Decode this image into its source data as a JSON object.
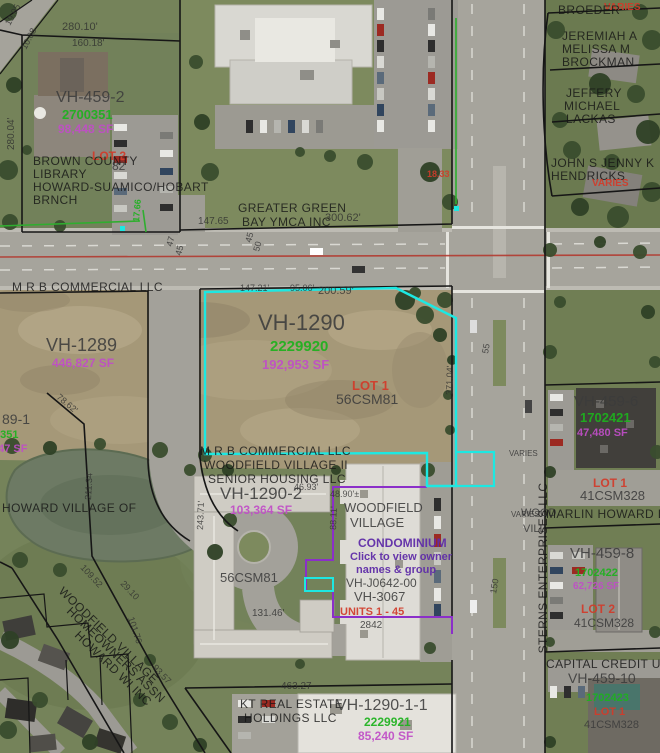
{
  "map": {
    "selected_parcel": "VH-1290",
    "colors": {
      "highlight": "#1de8e2",
      "boundary": "#161616",
      "condo_boundary": "#8b2fc9",
      "road_centerline": "#b23a30",
      "survey_green": "#2fae2f",
      "value_green": "#1db21d",
      "area_magenta": "#c04ec7",
      "lot_red": "#d23b2a"
    },
    "labels": [
      {
        "name": "dim-280-10",
        "text": "280.10'",
        "x": 62,
        "y": 30,
        "cls": "dim",
        "size": 11
      },
      {
        "name": "dim-160-18",
        "text": "160.18'",
        "x": 72,
        "y": 46,
        "cls": "dim",
        "size": 10
      },
      {
        "name": "dim-19-95",
        "text": "19.95",
        "x": 10,
        "y": 26,
        "cls": "dim",
        "size": 9,
        "rot": -62
      },
      {
        "name": "dim-10-08",
        "text": "10.08",
        "x": 26,
        "y": 50,
        "cls": "dim",
        "size": 9,
        "rot": -62
      },
      {
        "name": "dim-280-04",
        "text": "280.04'",
        "x": 14,
        "y": 150,
        "cls": "dim",
        "size": 10,
        "rot": -90
      },
      {
        "name": "parcel-id-vh-459-2",
        "text": "VH-459-2",
        "x": 56,
        "y": 102,
        "cls": "id",
        "size": 16
      },
      {
        "name": "parcel-value-vh-459-2",
        "text": "2700351",
        "x": 62,
        "y": 119,
        "cls": "grn",
        "size": 13
      },
      {
        "name": "parcel-area-vh-459-2",
        "text": "98,448 SF",
        "x": 58,
        "y": 133,
        "cls": "mag",
        "size": 12
      },
      {
        "name": "lot-label-vh-459-2",
        "text": "LOT 2",
        "x": 92,
        "y": 160,
        "cls": "red",
        "size": 12
      },
      {
        "name": "csm-fragment-82",
        "text": "82",
        "x": 112,
        "y": 170,
        "cls": "id",
        "size": 12
      },
      {
        "name": "owner-library-1",
        "text": "BROWN COUNTY",
        "x": 33,
        "y": 165,
        "cls": "own"
      },
      {
        "name": "owner-library-2",
        "text": "LIBRARY",
        "x": 33,
        "y": 178,
        "cls": "own"
      },
      {
        "name": "owner-library-3",
        "text": "HOWARD-SUAMICO/HOBART",
        "x": 33,
        "y": 191,
        "cls": "own"
      },
      {
        "name": "owner-library-4",
        "text": "BRNCH",
        "x": 33,
        "y": 204,
        "cls": "own"
      },
      {
        "name": "owner-ymca-1",
        "text": "GREATER GREEN",
        "x": 238,
        "y": 212,
        "cls": "own"
      },
      {
        "name": "owner-ymca-2",
        "text": "BAY YMCA INC",
        "x": 242,
        "y": 226,
        "cls": "own"
      },
      {
        "name": "dim-147-65",
        "text": "147.65",
        "x": 198,
        "y": 224,
        "cls": "dim",
        "size": 10
      },
      {
        "name": "dim-300-62",
        "text": "300.62'",
        "x": 325,
        "y": 221,
        "cls": "dim",
        "size": 11
      },
      {
        "name": "dim-47",
        "text": "47",
        "x": 172,
        "y": 247,
        "cls": "dim",
        "size": 9,
        "rot": -75
      },
      {
        "name": "dim-45a",
        "text": "45",
        "x": 181,
        "y": 256,
        "cls": "dim",
        "size": 9,
        "rot": -75
      },
      {
        "name": "dim-45b",
        "text": "45",
        "x": 251,
        "y": 243,
        "cls": "dim",
        "size": 9,
        "rot": -75
      },
      {
        "name": "dim-50",
        "text": "50",
        "x": 259,
        "y": 252,
        "cls": "dim",
        "size": 9,
        "rot": -75
      },
      {
        "name": "dim-18-33",
        "text": "18.33",
        "x": 427,
        "y": 177,
        "cls": "red",
        "size": 9
      },
      {
        "name": "dim-17-66",
        "text": "17.66",
        "x": 139,
        "y": 222,
        "cls": "grn",
        "size": 9,
        "rot": -85
      },
      {
        "name": "dim-147-21",
        "text": "147.21'",
        "x": 240,
        "y": 291,
        "cls": "dim",
        "size": 9
      },
      {
        "name": "dim-95-06",
        "text": "95.06'",
        "x": 290,
        "y": 291,
        "cls": "dim",
        "size": 9
      },
      {
        "name": "dim-200-59",
        "text": "200.59'",
        "x": 318,
        "y": 294,
        "cls": "dim",
        "size": 11
      },
      {
        "name": "dim-varies-1",
        "text": "VARIES",
        "x": 604,
        "y": 10,
        "cls": "red",
        "size": 10
      },
      {
        "name": "owner-broeder",
        "text": "BROEDER",
        "x": 558,
        "y": 14,
        "cls": "own",
        "size": 10
      },
      {
        "name": "owner-brockman-1",
        "text": "JEREMIAH A",
        "x": 562,
        "y": 40,
        "cls": "own"
      },
      {
        "name": "owner-brockman-2",
        "text": "MELISSA M",
        "x": 562,
        "y": 53,
        "cls": "own"
      },
      {
        "name": "owner-brockman-3",
        "text": "BROCKMAN",
        "x": 562,
        "y": 66,
        "cls": "own"
      },
      {
        "name": "owner-lackas-1",
        "text": "JEFFERY",
        "x": 566,
        "y": 97,
        "cls": "own"
      },
      {
        "name": "owner-lackas-2",
        "text": "MICHAEL",
        "x": 564,
        "y": 110,
        "cls": "own"
      },
      {
        "name": "owner-lackas-3",
        "text": "LACKAS",
        "x": 566,
        "y": 123,
        "cls": "own"
      },
      {
        "name": "owner-hendricks-1",
        "text": "JOHN S JENNY K",
        "x": 551,
        "y": 167,
        "cls": "own"
      },
      {
        "name": "owner-hendricks-2",
        "text": "HENDRICKS",
        "x": 551,
        "y": 180,
        "cls": "own"
      },
      {
        "name": "dim-varies-2",
        "text": "VARIES",
        "x": 592,
        "y": 186,
        "cls": "red",
        "size": 10
      },
      {
        "name": "owner-mrb-north",
        "text": "M R B COMMERCIAL LLC",
        "x": 12,
        "y": 291,
        "cls": "own"
      },
      {
        "name": "parcel-id-vh-1289",
        "text": "VH-1289",
        "x": 46,
        "y": 351,
        "cls": "id",
        "size": 18
      },
      {
        "name": "parcel-area-vh-1289",
        "text": "446,827 SF",
        "x": 52,
        "y": 367,
        "cls": "mag",
        "size": 12
      },
      {
        "name": "parcel-id-vh-1289-1",
        "text": "89-1",
        "x": 2,
        "y": 424,
        "cls": "id",
        "size": 14
      },
      {
        "name": "parcel-value-vh-1289-1",
        "text": "0351",
        "x": -6,
        "y": 438,
        "cls": "grn",
        "size": 11
      },
      {
        "name": "parcel-area-vh-1289-1",
        "text": "947 SF",
        "x": -8,
        "y": 452,
        "cls": "mag",
        "size": 11
      },
      {
        "name": "owner-howard-village",
        "text": "HOWARD VILLAGE OF",
        "x": 2,
        "y": 512,
        "cls": "own",
        "size": 11
      },
      {
        "name": "dim-78-62",
        "text": "78.62'",
        "x": 56,
        "y": 398,
        "cls": "dim",
        "size": 9,
        "rot": 40
      },
      {
        "name": "dim-211-34",
        "text": "211.34'",
        "x": 91,
        "y": 500,
        "cls": "dim",
        "size": 9,
        "rot": -87
      },
      {
        "name": "parcel-id-vh-1290",
        "text": "VH-1290",
        "x": 258,
        "y": 330,
        "cls": "id",
        "size": 22
      },
      {
        "name": "parcel-value-vh-1290",
        "text": "2229920",
        "x": 270,
        "y": 351,
        "cls": "grn",
        "size": 15
      },
      {
        "name": "parcel-area-vh-1290",
        "text": "192,953 SF",
        "x": 262,
        "y": 369,
        "cls": "mag",
        "size": 13
      },
      {
        "name": "lot-label-vh-1290",
        "text": "LOT 1",
        "x": 352,
        "y": 390,
        "cls": "red",
        "size": 13
      },
      {
        "name": "csm-vh-1290",
        "text": "56CSM81",
        "x": 336,
        "y": 404,
        "cls": "id",
        "size": 14
      },
      {
        "name": "dim-371-04",
        "text": "371.04'",
        "x": 452,
        "y": 395,
        "cls": "dim",
        "size": 9,
        "rot": -88
      },
      {
        "name": "dim-55",
        "text": "55",
        "x": 488,
        "y": 354,
        "cls": "dim",
        "size": 9,
        "rot": -80
      },
      {
        "name": "owner-mrb-2",
        "text": "M R B COMMERCIAL LLC",
        "x": 200,
        "y": 455,
        "cls": "own"
      },
      {
        "name": "owner-woodfield-village-ii",
        "text": "WOODFIELD VILLAGE II",
        "x": 204,
        "y": 469,
        "cls": "own"
      },
      {
        "name": "owner-senior-housing",
        "text": "SENIOR HOUSING LLC",
        "x": 208,
        "y": 483,
        "cls": "own"
      },
      {
        "name": "parcel-id-vh-1290-2",
        "text": "VH-1290-2",
        "x": 220,
        "y": 499,
        "cls": "id",
        "size": 17
      },
      {
        "name": "parcel-area-vh-1290-2",
        "text": "103,364 SF",
        "x": 230,
        "y": 514,
        "cls": "mag",
        "size": 12
      },
      {
        "name": "dim-46-93",
        "text": "46.93'",
        "x": 294,
        "y": 490,
        "cls": "dim",
        "size": 9
      },
      {
        "name": "dim-48-90",
        "text": "48.90'±",
        "x": 330,
        "y": 497,
        "cls": "dim",
        "size": 9
      },
      {
        "name": "dim-88-11",
        "text": "88.11'",
        "x": 336,
        "y": 530,
        "cls": "dim",
        "size": 9,
        "rot": -88
      },
      {
        "name": "dim-243-71",
        "text": "243.71'",
        "x": 203,
        "y": 530,
        "cls": "dim",
        "size": 9,
        "rot": -88
      },
      {
        "name": "csm-vh-1290-2",
        "text": "56CSM81",
        "x": 220,
        "y": 582,
        "cls": "id",
        "size": 13
      },
      {
        "name": "dim-131-46",
        "text": "131.46'",
        "x": 252,
        "y": 616,
        "cls": "dim",
        "size": 10
      },
      {
        "name": "condo-name-1",
        "text": "WOODFIELD",
        "x": 344,
        "y": 512,
        "cls": "id",
        "size": 13
      },
      {
        "name": "condo-name-2",
        "text": "VILLAGE",
        "x": 350,
        "y": 527,
        "cls": "id",
        "size": 13
      },
      {
        "name": "condo-link-title",
        "text": "CONDOMINIUM",
        "x": 358,
        "y": 547,
        "cls": "lnk",
        "size": 12,
        "interactable": true
      },
      {
        "name": "condo-link-line-1",
        "text": "Click to view owner",
        "x": 350,
        "y": 560,
        "cls": "lnk",
        "size": 11,
        "interactable": true
      },
      {
        "name": "condo-link-line-2",
        "text": "names & group",
        "x": 356,
        "y": 573,
        "cls": "lnk",
        "size": 11,
        "interactable": true
      },
      {
        "name": "condo-id-j0642",
        "text": "VH-J0642-00",
        "x": 346,
        "y": 587,
        "cls": "id",
        "size": 12
      },
      {
        "name": "condo-id-vh-3067",
        "text": "VH-3067",
        "x": 354,
        "y": 601,
        "cls": "id",
        "size": 13
      },
      {
        "name": "condo-units",
        "text": "UNITS 1 - 45",
        "x": 340,
        "y": 615,
        "cls": "red",
        "size": 11
      },
      {
        "name": "condo-num",
        "text": "2842",
        "x": 360,
        "y": 628,
        "cls": "id",
        "size": 10
      },
      {
        "name": "frag-wood",
        "text": "WOOD",
        "x": 521,
        "y": 516,
        "cls": "id",
        "size": 11
      },
      {
        "name": "frag-vill",
        "text": "VILL",
        "x": 523,
        "y": 532,
        "cls": "id",
        "size": 11
      },
      {
        "name": "dim-varies-3",
        "text": "VARIES",
        "x": 509,
        "y": 456,
        "cls": "dim",
        "size": 8
      },
      {
        "name": "dim-varies-4",
        "text": "VARIES",
        "x": 511,
        "y": 517,
        "cls": "dim",
        "size": 8
      },
      {
        "name": "dim-150",
        "text": "150",
        "x": 496,
        "y": 594,
        "cls": "dim",
        "size": 9,
        "rot": -80
      },
      {
        "name": "parcel-id-vh-459-6",
        "text": "VH-459-6",
        "x": 574,
        "y": 406,
        "cls": "id",
        "size": 15
      },
      {
        "name": "parcel-value-vh-459-6",
        "text": "1702421",
        "x": 580,
        "y": 422,
        "cls": "grn",
        "size": 13
      },
      {
        "name": "parcel-area-vh-459-6",
        "text": "47,480 SF",
        "x": 577,
        "y": 436,
        "cls": "mag",
        "size": 11
      },
      {
        "name": "lot-label-vh-459-6",
        "text": "LOT 1",
        "x": 593,
        "y": 487,
        "cls": "red",
        "size": 12
      },
      {
        "name": "csm-vh-459-6",
        "text": "41CSM328",
        "x": 580,
        "y": 500,
        "cls": "id",
        "size": 13
      },
      {
        "name": "owner-marlin-howard",
        "text": "MARLIN HOWARD LLC",
        "x": 546,
        "y": 518,
        "cls": "own"
      },
      {
        "name": "owner-sterns",
        "text": "STERNS ENTERPRISES LLC",
        "x": 547,
        "y": 568,
        "cls": "own",
        "size": 10,
        "rot": -90,
        "anchor": "middle"
      },
      {
        "name": "parcel-id-vh-459-8",
        "text": "VH-459-8",
        "x": 570,
        "y": 558,
        "cls": "id",
        "size": 15
      },
      {
        "name": "parcel-value-vh-459-8",
        "text": "1702422",
        "x": 575,
        "y": 576,
        "cls": "grn",
        "size": 11
      },
      {
        "name": "parcel-area-vh-459-8",
        "text": "62,726 SF",
        "x": 573,
        "y": 589,
        "cls": "mag",
        "size": 10
      },
      {
        "name": "lot-label-vh-459-8",
        "text": "LOT 2",
        "x": 581,
        "y": 613,
        "cls": "red",
        "size": 12
      },
      {
        "name": "csm-vh-459-8",
        "text": "41CSM328",
        "x": 574,
        "y": 627,
        "cls": "id",
        "size": 12
      },
      {
        "name": "owner-capital-credit-union",
        "text": "CAPITAL CREDIT UNION",
        "x": 546,
        "y": 668,
        "cls": "own"
      },
      {
        "name": "parcel-id-vh-459-10",
        "text": "VH-459-10",
        "x": 568,
        "y": 683,
        "cls": "id",
        "size": 14
      },
      {
        "name": "parcel-value-vh-459-10",
        "text": "1702423",
        "x": 586,
        "y": 701,
        "cls": "grn",
        "size": 11
      },
      {
        "name": "lot-label-vh-459-10",
        "text": "LOT 1",
        "x": 594,
        "y": 715,
        "cls": "red",
        "size": 11
      },
      {
        "name": "csm-vh-459-10",
        "text": "41CSM328",
        "x": 584,
        "y": 728,
        "cls": "id",
        "size": 11
      },
      {
        "name": "dim-463-27",
        "text": "463.27",
        "x": 281,
        "y": 689,
        "cls": "dim",
        "size": 10
      },
      {
        "name": "owner-kt-1",
        "text": "KT REAL ESTATE",
        "x": 240,
        "y": 708,
        "cls": "own"
      },
      {
        "name": "owner-kt-2",
        "text": "HOLDINGS LLC",
        "x": 244,
        "y": 722,
        "cls": "own"
      },
      {
        "name": "parcel-id-vh-1290-1-1",
        "text": "VH-1290-1-1",
        "x": 336,
        "y": 710,
        "cls": "id",
        "size": 16
      },
      {
        "name": "parcel-value-vh-1290-1-1",
        "text": "2229921",
        "x": 364,
        "y": 726,
        "cls": "grn",
        "size": 12
      },
      {
        "name": "parcel-area-vh-1290-1-1",
        "text": "85,240 SF",
        "x": 358,
        "y": 740,
        "cls": "mag",
        "size": 12
      },
      {
        "name": "owner-hoa-1",
        "text": "WOODFIELD VILLAGE",
        "x": 58,
        "y": 592,
        "cls": "own",
        "rot": 44
      },
      {
        "name": "owner-hoa-2",
        "text": "HOMEOWNERS ASSN",
        "x": 66,
        "y": 612,
        "cls": "own",
        "rot": 44
      },
      {
        "name": "owner-hoa-3",
        "text": "HOWARD WI INC",
        "x": 74,
        "y": 636,
        "cls": "own",
        "rot": 44
      },
      {
        "name": "dim-109-52",
        "text": "109.52",
        "x": 80,
        "y": 568,
        "cls": "dim",
        "size": 9,
        "rot": 47
      },
      {
        "name": "dim-29-10",
        "text": "29.10",
        "x": 120,
        "y": 584,
        "cls": "dim",
        "size": 9,
        "rot": 47
      },
      {
        "name": "dim-101-76",
        "text": "101.76",
        "x": 128,
        "y": 618,
        "cls": "dim",
        "size": 9,
        "rot": 72
      },
      {
        "name": "dim-93-57",
        "text": "93.57",
        "x": 152,
        "y": 668,
        "cls": "dim",
        "size": 9,
        "rot": 47
      }
    ]
  }
}
